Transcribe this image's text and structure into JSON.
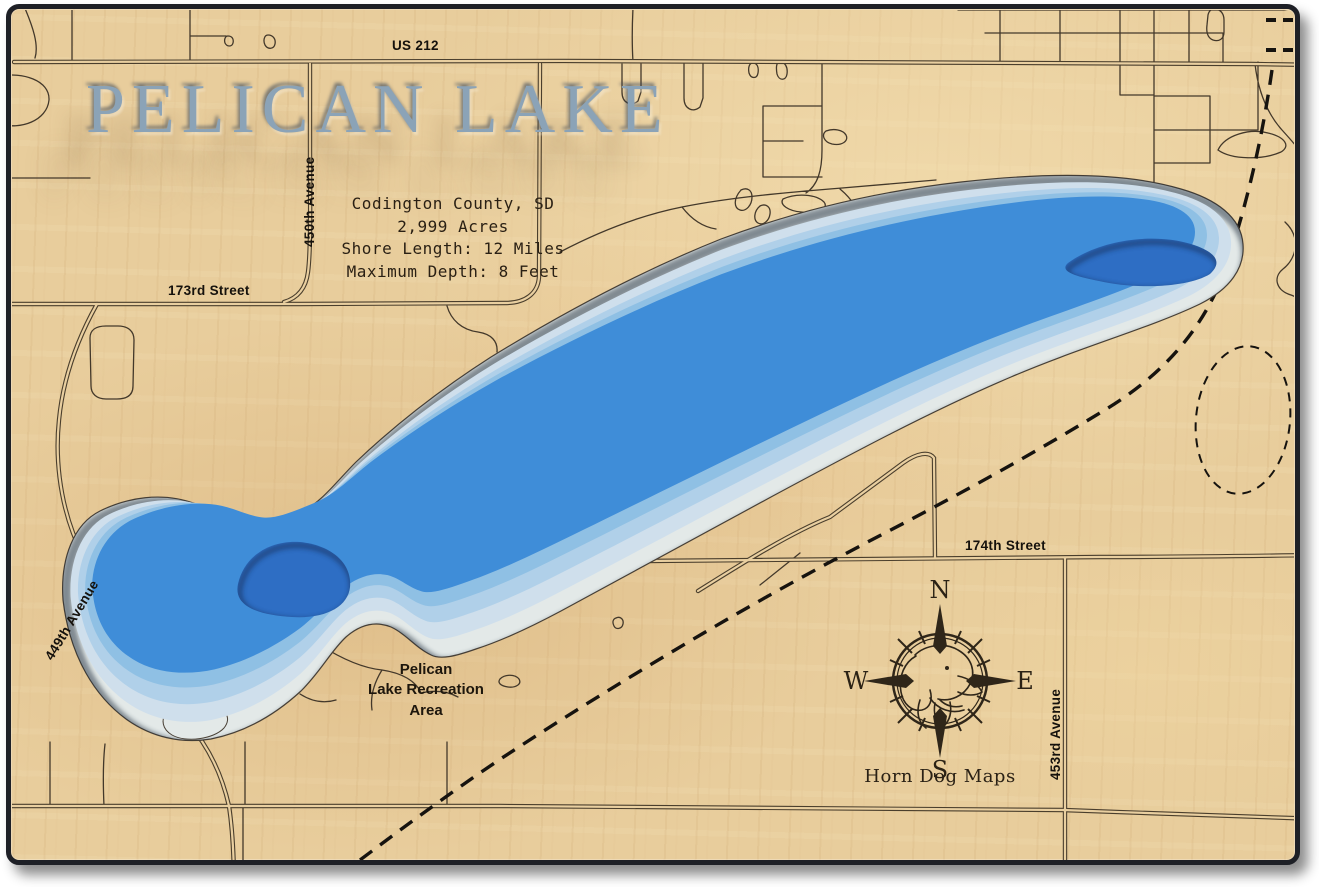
{
  "title": "PELICAN LAKE",
  "info": {
    "county": "Codington County, SD",
    "acres": "2,999 Acres",
    "shore_length": "Shore Length: 12 Miles",
    "max_depth": "Maximum Depth: 8 Feet"
  },
  "roads": {
    "us212": "US 212",
    "ave450": "450th Avenue",
    "st173": "173rd Street",
    "st174": "174th Street",
    "ave449": "449th Avenue",
    "ave453": "453rd Avenue"
  },
  "poi": {
    "recreation_line1": "Pelican",
    "recreation_line2": "Lake Recreation",
    "recreation_line3": "Area"
  },
  "compass": {
    "n": "N",
    "e": "E",
    "s": "S",
    "w": "W",
    "maker": "Horn Dog Maps"
  },
  "colors": {
    "wood": "#e8cd9c",
    "frame": "#1e2026",
    "contour_0": "#e3e9e8",
    "contour_1": "#cfdfec",
    "contour_2": "#b0d0e9",
    "contour_3": "#8fc0e4",
    "lake_main": "#3f8dd8",
    "lake_deep": "#2e6ec4",
    "title_text": "#8ba3b7",
    "road_line": "#43382a"
  }
}
